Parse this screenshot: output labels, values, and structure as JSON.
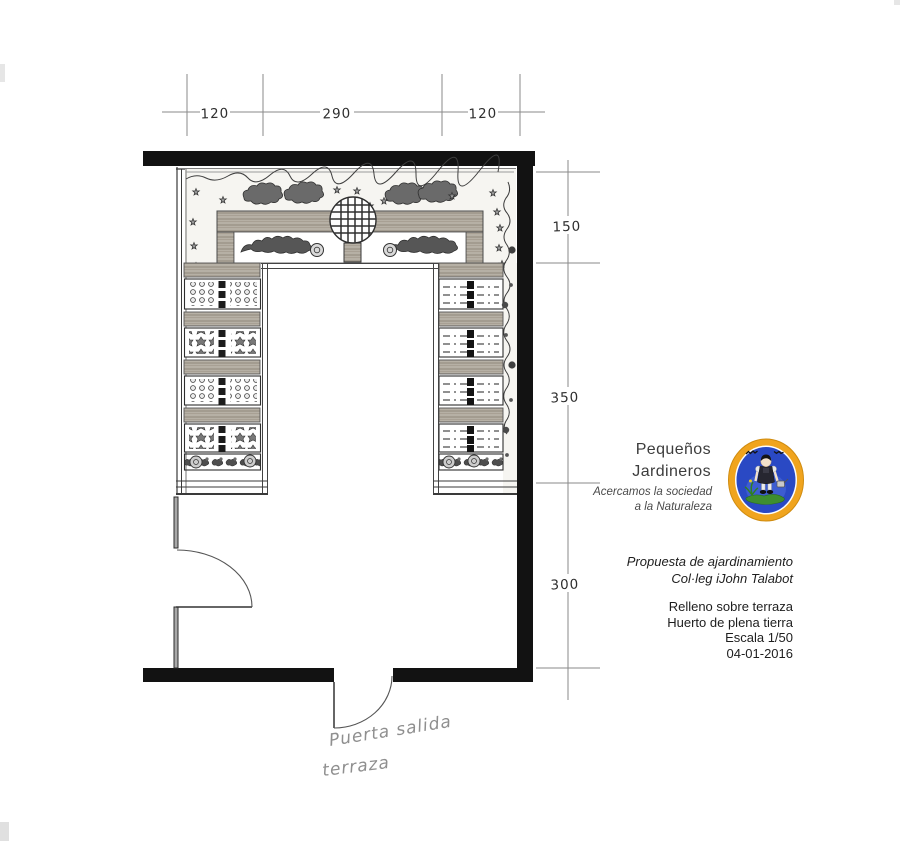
{
  "plan": {
    "dimensions_top": [
      "120",
      "290",
      "120"
    ],
    "dimensions_right": [
      "150",
      "350",
      "300"
    ],
    "note_line1": "Puerta salida",
    "note_line2": "terraza"
  },
  "branding": {
    "name_line1": "Pequeños",
    "name_line2": "Jardineros",
    "tagline_line1": "Acercamos la sociedad",
    "tagline_line2": "a la Naturaleza",
    "colors": {
      "ring": "#F0A41E",
      "field": "#2A49C4",
      "ground": "#3E8E2F"
    }
  },
  "title_block": {
    "project_line1": "Propuesta de ajardinamiento",
    "project_line2": "Col·leg iJohn Talabot",
    "detail_line1": "Relleno sobre terraza",
    "detail_line2": "Huerto de plena tierra",
    "scale": "Escala 1/50",
    "date": "04-01-2016"
  }
}
